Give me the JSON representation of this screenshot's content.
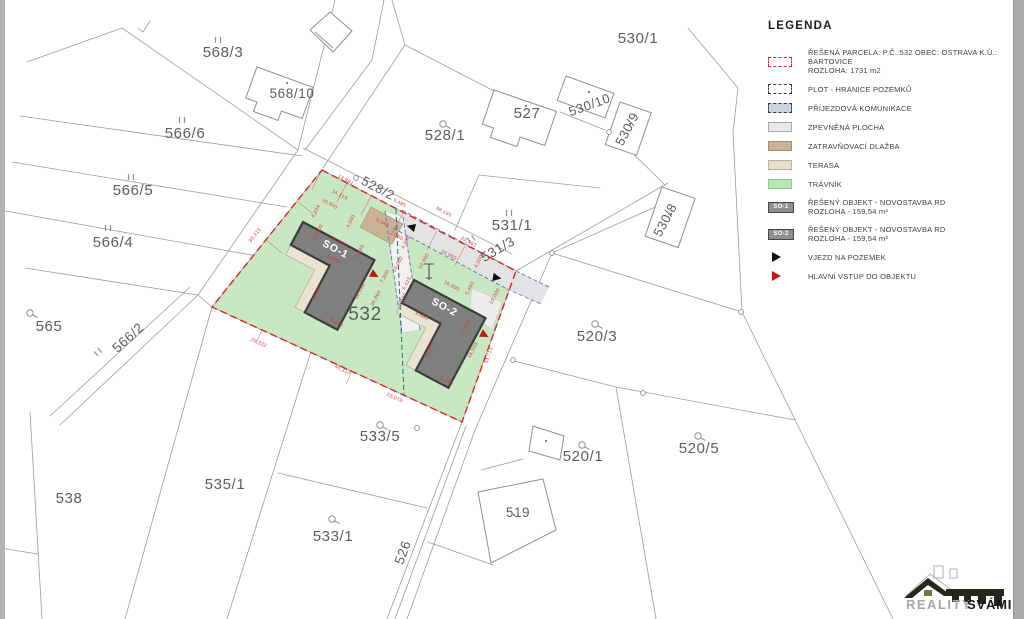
{
  "colors": {
    "grass": "#c7e8c2",
    "boundary_red": "#df2020",
    "building": "#7f7f7f",
    "building_border": "#3d3d3d",
    "terrace": "#eae3d1",
    "terrace_border": "#b4ac93",
    "tan": "#c9b295",
    "tan_border": "#a8906f",
    "paving": "#f1f1f1",
    "band": "#e3e3e3",
    "drive": "#5b79a8",
    "line": "#9c9c9c",
    "dim": "#cf3a3a",
    "label": "#5d5d5d",
    "split": "#2a6e6e",
    "arrow_black": "#111111",
    "arrow_red": "#cc1414"
  },
  "legend": {
    "title": "LEGENDA",
    "items": [
      {
        "kind": "dash",
        "fill": "#ffffff",
        "border": "#d92121",
        "lines": [
          "ŘEŠENÁ PARCELA:  P.Č.:532 OBEC: OSTRAVA K.Ú.: BARTOVICE",
          "ROZLOHA:  1731 m2"
        ]
      },
      {
        "kind": "dash",
        "fill": "#ffffff",
        "border": "#3a3a3a",
        "lines": [
          "PLOT - HRANICE POZEMKŮ"
        ]
      },
      {
        "kind": "dash",
        "fill": "#ccd3de",
        "border": "#3a3a3a",
        "lines": [
          "PŘÍJEZDOVÁ KOMUNIKACE"
        ]
      },
      {
        "kind": "solid",
        "fill": "#e9ebea",
        "border": "#a8a8a8",
        "lines": [
          "ZPEVNĚNÁ PLOCHA"
        ]
      },
      {
        "kind": "solid",
        "fill": "#c9b295",
        "border": "#a8906f",
        "lines": [
          "ZATRAVŇOVACÍ DLAŽBA"
        ]
      },
      {
        "kind": "solid",
        "fill": "#e6dfcb",
        "border": "#b9b19a",
        "lines": [
          "TERASA"
        ]
      },
      {
        "kind": "solid",
        "fill": "#b9e5b4",
        "border": "#8cc98a",
        "lines": [
          "TRÁVNÍK"
        ]
      },
      {
        "kind": "badge",
        "fill": "#8f8f8f",
        "border": "#474747",
        "badge": "SO-1",
        "lines": [
          "ŘEŠENÝ OBJEKT - NOVOSTAVBA RD",
          "ROZLOHA - 159,54 m²"
        ]
      },
      {
        "kind": "badge",
        "fill": "#8f8f8f",
        "border": "#474747",
        "badge": "SO-2",
        "lines": [
          "ŘEŠENÝ OBJEKT - NOVOSTAVBA RD",
          "ROZLOHA - 159,54 m²"
        ]
      },
      {
        "kind": "arrow",
        "fill": "#111111",
        "lines": [
          "VJEZD NA POZEMEK"
        ]
      },
      {
        "kind": "arrow",
        "fill": "#cc1414",
        "lines": [
          "HLAVNÍ VSTUP DO OBJEKTU"
        ]
      }
    ]
  },
  "map": {
    "parcel_labels": [
      {
        "id": "p568_3",
        "text": "568/3"
      },
      {
        "id": "p568_10",
        "text": "568/10"
      },
      {
        "id": "p566_6",
        "text": "566/6"
      },
      {
        "id": "p566_5",
        "text": "566/5"
      },
      {
        "id": "p566_4",
        "text": "566/4"
      },
      {
        "id": "p565",
        "text": "565"
      },
      {
        "id": "p566_2",
        "text": "566/2"
      },
      {
        "id": "p538",
        "text": "538"
      },
      {
        "id": "p535_1",
        "text": "535/1"
      },
      {
        "id": "p533_5",
        "text": "533/5"
      },
      {
        "id": "p533_1",
        "text": "533/1"
      },
      {
        "id": "p526",
        "text": "526"
      },
      {
        "id": "p519",
        "text": "519"
      },
      {
        "id": "p520_1",
        "text": "520/1"
      },
      {
        "id": "p520_3",
        "text": "520/3"
      },
      {
        "id": "p520_5",
        "text": "520/5"
      },
      {
        "id": "p530_1",
        "text": "530/1"
      },
      {
        "id": "p527",
        "text": "527"
      },
      {
        "id": "p530_10",
        "text": "530/10"
      },
      {
        "id": "p530_9",
        "text": "530/9"
      },
      {
        "id": "p530_8",
        "text": "530/8"
      },
      {
        "id": "p531_1",
        "text": "531/1"
      },
      {
        "id": "p531_3",
        "text": "531/3"
      },
      {
        "id": "p528_1",
        "text": "528/1"
      },
      {
        "id": "p528_2",
        "text": "528/2"
      },
      {
        "id": "p532",
        "text": "532"
      }
    ],
    "building_labels": [
      {
        "id": "so1",
        "text": "SO-1"
      },
      {
        "id": "so2",
        "text": "SO-2"
      }
    ],
    "dimensions": [
      {
        "text": "13,981"
      },
      {
        "text": "14,319"
      },
      {
        "text": "10,000"
      },
      {
        "text": "4,834"
      },
      {
        "text": "4,000"
      },
      {
        "text": "9,485"
      },
      {
        "text": "48,195"
      },
      {
        "text": "6,060"
      },
      {
        "text": "2,000"
      },
      {
        "text": "4,000"
      },
      {
        "text": "16,060"
      },
      {
        "text": "10,000"
      },
      {
        "text": "5,460"
      },
      {
        "text": "36,215"
      },
      {
        "text": "16,060"
      },
      {
        "text": "10,000"
      },
      {
        "text": "23,183"
      },
      {
        "text": "16,000"
      },
      {
        "text": "5,425"
      },
      {
        "text": "5,460"
      },
      {
        "text": "10,000"
      },
      {
        "text": "7,800"
      },
      {
        "text": "9,680"
      },
      {
        "text": "11,980"
      },
      {
        "text": "18,000"
      },
      {
        "text": "34,060"
      },
      {
        "text": "8,310"
      },
      {
        "text": "9,680"
      },
      {
        "text": "11,980"
      },
      {
        "text": "18,000"
      },
      {
        "text": "8,310"
      },
      {
        "text": "20,332"
      },
      {
        "text": "46,310"
      },
      {
        "text": "23,078"
      },
      {
        "text": "33,713"
      },
      {
        "text": "4,000"
      },
      {
        "text": "1,480"
      },
      {
        "text": "10,000"
      },
      {
        "text": "9,180"
      }
    ]
  },
  "logo": {
    "line_light": "REALITY",
    "line_bold": "SVÁMI"
  }
}
